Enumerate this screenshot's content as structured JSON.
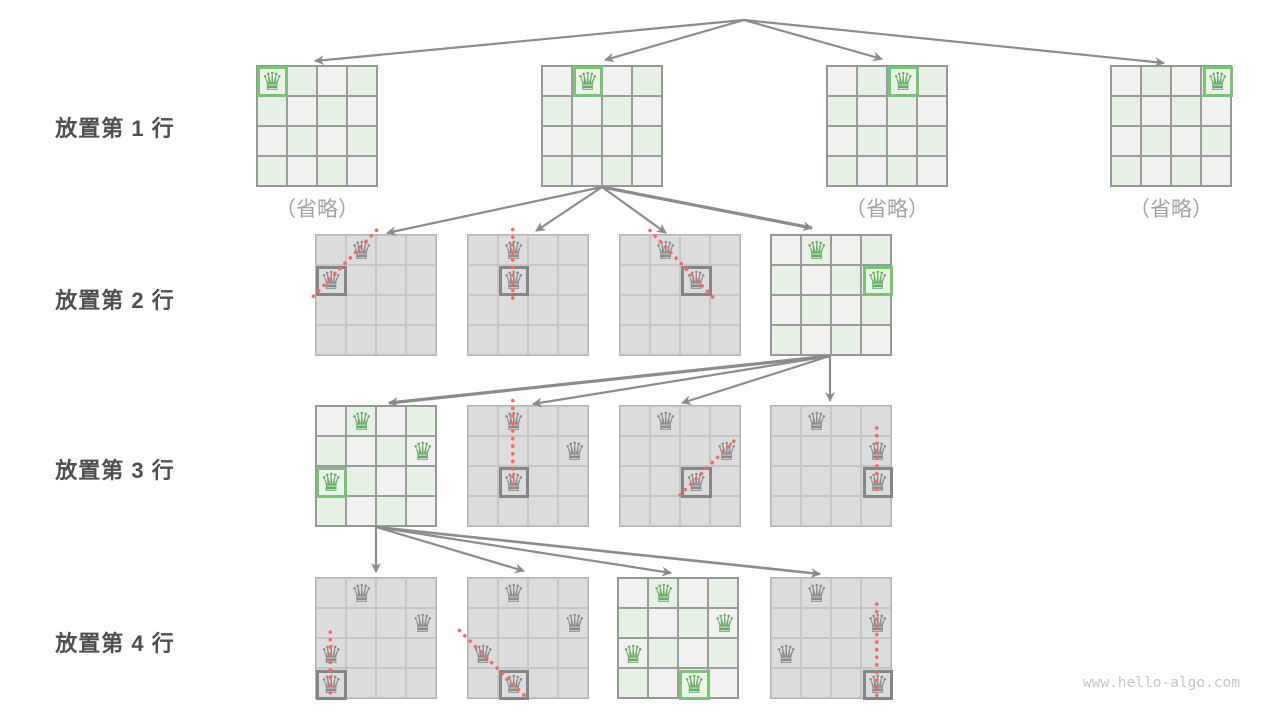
{
  "rows": [
    {
      "label": "放置第 1 行"
    },
    {
      "label": "放置第 2 行"
    },
    {
      "label": "放置第 3 行"
    },
    {
      "label": "放置第 4 行"
    }
  ],
  "omitted_label": "（省略）",
  "watermark": "www.hello-algo.com",
  "colors": {
    "queen_green": "#69aa67",
    "queen_gray": "#8a8a8a",
    "box_green": "#7cc07a",
    "box_gray": "#868686",
    "cell_light": "#f1f1f0",
    "cell_green": "#e7f0e4",
    "cell_dead": "#dcdcdc",
    "arrow": "#8c8c8c",
    "conflict_red": "#f26a6a",
    "label_dark": "#4f4f4f",
    "label_muted": "#a3a3a3"
  },
  "layout": {
    "cell": 30.5,
    "board": 122
  },
  "boards": [
    {
      "name": "row1-board1",
      "x": 256,
      "y": 65,
      "state": "active",
      "omitted": true,
      "queens": [
        {
          "r": 0,
          "c": 0,
          "boxed": true
        }
      ]
    },
    {
      "name": "row1-board2",
      "x": 541,
      "y": 65,
      "state": "active",
      "omitted": false,
      "queens": [
        {
          "r": 0,
          "c": 1,
          "boxed": true
        }
      ]
    },
    {
      "name": "row1-board3",
      "x": 826,
      "y": 65,
      "state": "active",
      "omitted": true,
      "queens": [
        {
          "r": 0,
          "c": 2,
          "boxed": true
        }
      ]
    },
    {
      "name": "row1-board4",
      "x": 1110,
      "y": 65,
      "state": "active",
      "omitted": true,
      "queens": [
        {
          "r": 0,
          "c": 3,
          "boxed": true
        }
      ]
    },
    {
      "name": "row2-board1",
      "x": 315,
      "y": 234,
      "state": "pruned",
      "omitted": false,
      "queens": [
        {
          "r": 0,
          "c": 1
        },
        {
          "r": 1,
          "c": 0,
          "boxed": true
        }
      ]
    },
    {
      "name": "row2-board2",
      "x": 467,
      "y": 234,
      "state": "pruned",
      "omitted": false,
      "queens": [
        {
          "r": 0,
          "c": 1
        },
        {
          "r": 1,
          "c": 1,
          "boxed": true
        }
      ]
    },
    {
      "name": "row2-board3",
      "x": 619,
      "y": 234,
      "state": "pruned",
      "omitted": false,
      "queens": [
        {
          "r": 0,
          "c": 1
        },
        {
          "r": 1,
          "c": 2,
          "boxed": true
        }
      ]
    },
    {
      "name": "row2-board4",
      "x": 770,
      "y": 234,
      "state": "active",
      "omitted": false,
      "queens": [
        {
          "r": 0,
          "c": 1
        },
        {
          "r": 1,
          "c": 3,
          "boxed": true
        }
      ]
    },
    {
      "name": "row3-board1",
      "x": 315,
      "y": 405,
      "state": "active",
      "omitted": false,
      "queens": [
        {
          "r": 0,
          "c": 1
        },
        {
          "r": 1,
          "c": 3
        },
        {
          "r": 2,
          "c": 0,
          "boxed": true
        }
      ]
    },
    {
      "name": "row3-board2",
      "x": 467,
      "y": 405,
      "state": "pruned",
      "omitted": false,
      "queens": [
        {
          "r": 0,
          "c": 1
        },
        {
          "r": 1,
          "c": 3
        },
        {
          "r": 2,
          "c": 1,
          "boxed": true
        }
      ]
    },
    {
      "name": "row3-board3",
      "x": 619,
      "y": 405,
      "state": "pruned",
      "omitted": false,
      "queens": [
        {
          "r": 0,
          "c": 1
        },
        {
          "r": 1,
          "c": 3
        },
        {
          "r": 2,
          "c": 2,
          "boxed": true
        }
      ]
    },
    {
      "name": "row3-board4",
      "x": 770,
      "y": 405,
      "state": "pruned",
      "omitted": false,
      "queens": [
        {
          "r": 0,
          "c": 1
        },
        {
          "r": 1,
          "c": 3
        },
        {
          "r": 2,
          "c": 3,
          "boxed": true
        }
      ]
    },
    {
      "name": "row4-board1",
      "x": 315,
      "y": 577,
      "state": "pruned",
      "omitted": false,
      "queens": [
        {
          "r": 0,
          "c": 1
        },
        {
          "r": 1,
          "c": 3
        },
        {
          "r": 2,
          "c": 0
        },
        {
          "r": 3,
          "c": 0,
          "boxed": true
        }
      ]
    },
    {
      "name": "row4-board2",
      "x": 467,
      "y": 577,
      "state": "pruned",
      "omitted": false,
      "queens": [
        {
          "r": 0,
          "c": 1
        },
        {
          "r": 1,
          "c": 3
        },
        {
          "r": 2,
          "c": 0
        },
        {
          "r": 3,
          "c": 1,
          "boxed": true
        }
      ]
    },
    {
      "name": "row4-board3",
      "x": 617,
      "y": 577,
      "state": "active",
      "omitted": false,
      "queens": [
        {
          "r": 0,
          "c": 1
        },
        {
          "r": 1,
          "c": 3
        },
        {
          "r": 2,
          "c": 0
        },
        {
          "r": 3,
          "c": 2,
          "boxed": true
        }
      ]
    },
    {
      "name": "row4-board4",
      "x": 770,
      "y": 577,
      "state": "pruned",
      "omitted": false,
      "queens": [
        {
          "r": 0,
          "c": 1
        },
        {
          "r": 1,
          "c": 3
        },
        {
          "r": 2,
          "c": 0
        },
        {
          "r": 3,
          "c": 3,
          "boxed": true
        }
      ]
    }
  ],
  "arrows": [
    {
      "x1": 744,
      "y1": 20,
      "x2": 315,
      "y2": 61,
      "w": 2.2
    },
    {
      "x1": 744,
      "y1": 20,
      "x2": 605,
      "y2": 60,
      "w": 2.2
    },
    {
      "x1": 744,
      "y1": 20,
      "x2": 882,
      "y2": 59,
      "w": 2.2
    },
    {
      "x1": 744,
      "y1": 20,
      "x2": 1164,
      "y2": 63,
      "w": 2.2
    },
    {
      "x1": 602,
      "y1": 187,
      "x2": 387,
      "y2": 233,
      "w": 2.2
    },
    {
      "x1": 602,
      "y1": 187,
      "x2": 536,
      "y2": 231,
      "w": 2.2
    },
    {
      "x1": 602,
      "y1": 187,
      "x2": 666,
      "y2": 233,
      "w": 2.2
    },
    {
      "x1": 602,
      "y1": 187,
      "x2": 812,
      "y2": 228,
      "w": 3.2
    },
    {
      "x1": 830,
      "y1": 356,
      "x2": 389,
      "y2": 403,
      "w": 3.2
    },
    {
      "x1": 830,
      "y1": 356,
      "x2": 533,
      "y2": 404,
      "w": 2.2
    },
    {
      "x1": 830,
      "y1": 356,
      "x2": 682,
      "y2": 403,
      "w": 2.2
    },
    {
      "x1": 830,
      "y1": 356,
      "x2": 830,
      "y2": 401,
      "w": 2.2
    },
    {
      "x1": 376,
      "y1": 527,
      "x2": 376,
      "y2": 572,
      "w": 2.2
    },
    {
      "x1": 376,
      "y1": 527,
      "x2": 524,
      "y2": 571,
      "w": 2.2
    },
    {
      "x1": 376,
      "y1": 527,
      "x2": 671,
      "y2": 573,
      "w": 2.2
    },
    {
      "x1": 376,
      "y1": 527,
      "x2": 820,
      "y2": 574,
      "w": 2.6
    }
  ],
  "conflicts": [
    {
      "x1": 376.6,
      "y1": 230.3,
      "x2": 311.3,
      "y2": 298.5
    },
    {
      "x1": 512.8,
      "y1": 229.5,
      "x2": 512.8,
      "y2": 301.5
    },
    {
      "x1": 650.0,
      "y1": 230.5,
      "x2": 713.6,
      "y2": 298.0
    },
    {
      "x1": 512.8,
      "y1": 400.5,
      "x2": 512.8,
      "y2": 486.0
    },
    {
      "x1": 680.0,
      "y1": 495.0,
      "x2": 736.4,
      "y2": 438.5
    },
    {
      "x1": 876.8,
      "y1": 428.0,
      "x2": 876.8,
      "y2": 492.0
    },
    {
      "x1": 330.3,
      "y1": 632.0,
      "x2": 330.3,
      "y2": 697.0
    },
    {
      "x1": 459.4,
      "y1": 630.4,
      "x2": 526.5,
      "y2": 697.5
    },
    {
      "x1": 876.8,
      "y1": 604.0,
      "x2": 876.8,
      "y2": 698.0
    }
  ]
}
